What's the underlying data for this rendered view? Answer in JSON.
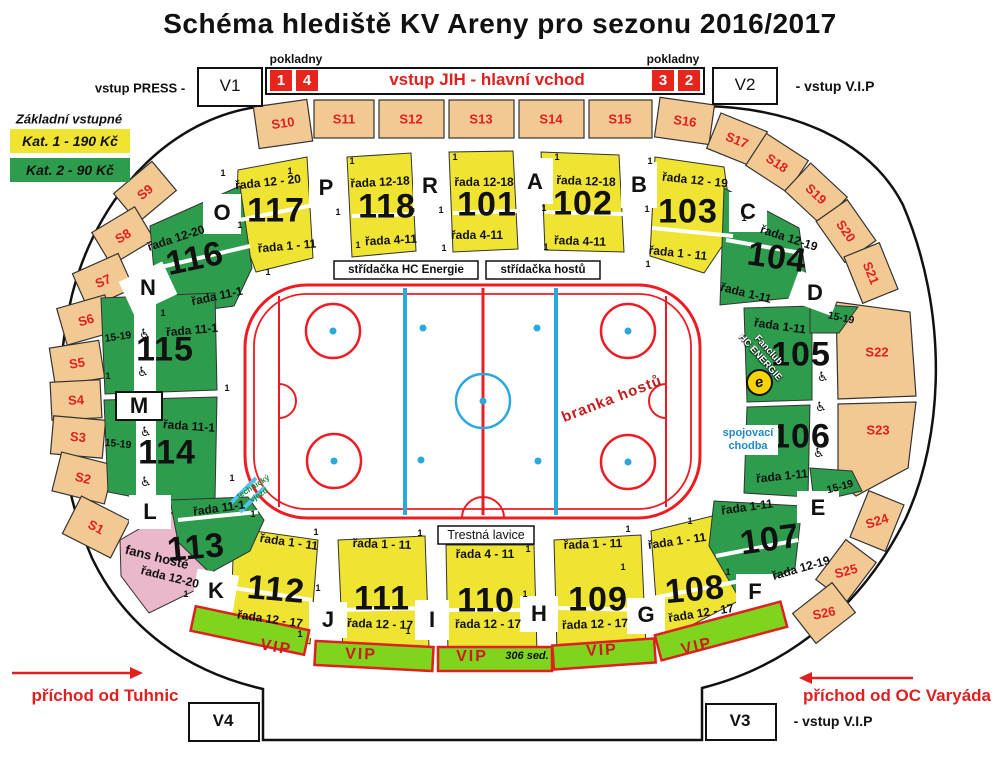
{
  "title": "Schéma hlediště KV Areny pro sezonu 2016/2017",
  "header": {
    "pokladny": "pokladny",
    "vstup_press": "vstup PRESS -",
    "gate": "vstup JIH - hlavní vchod",
    "vstup_vip": "- vstup V.I.P",
    "v1": "V1",
    "v2": "V2",
    "v3": "V3",
    "v4": "V4",
    "ticket_boxes": {
      "b1": "1",
      "b4": "4",
      "b3": "3",
      "b2": "2"
    }
  },
  "legend": {
    "heading": "Základní vstupné",
    "kat1": "Kat. 1 - 190 Kč",
    "kat2": "Kat. 2 - 90 Kč"
  },
  "approach": {
    "left": "příchod od Tuhnic",
    "right": "příchod od OC Varyáda"
  },
  "ring": {
    "s1": "S1",
    "s2": "S2",
    "s3": "S3",
    "s4": "S4",
    "s5": "S5",
    "s6": "S6",
    "s7": "S7",
    "s8": "S8",
    "s9": "S9",
    "s10": "S10",
    "s11": "S11",
    "s12": "S12",
    "s13": "S13",
    "s14": "S14",
    "s15": "S15",
    "s16": "S16",
    "s17": "S17",
    "s18": "S18",
    "s19": "S19",
    "s20": "S20",
    "s21": "S21",
    "s22": "S22",
    "s23": "S23",
    "s24": "S24",
    "s25": "S25",
    "s26": "S26"
  },
  "letters": {
    "a": "A",
    "b": "B",
    "c": "C",
    "d": "D",
    "e": "E",
    "f": "F",
    "g": "G",
    "h": "H",
    "i": "I",
    "j": "J",
    "k": "K",
    "l": "L",
    "m": "M",
    "n": "N",
    "o": "O",
    "p": "P",
    "r": "R"
  },
  "bowl": {
    "s101": {
      "num": "101",
      "top": "řada 12-18",
      "bottom": "řada 4-11"
    },
    "s102": {
      "num": "102",
      "top": "řada 12-18",
      "bottom": "řada 4-11"
    },
    "s103": {
      "num": "103",
      "top": "řada 12 - 19",
      "bottom": "řada 1 - 11"
    },
    "s104": {
      "num": "104",
      "top": "řada 12-19",
      "bottom": "řada 1-11"
    },
    "s105": {
      "num": "105",
      "rows": "řada 1-11"
    },
    "s106": {
      "num": "106",
      "rows": "řada 1-11"
    },
    "s107": {
      "num": "107",
      "top": "řada 1-11",
      "bottom": "řada 12-19"
    },
    "s108": {
      "num": "108",
      "top": "řada 1 - 11",
      "bottom": "řada 12 - 17"
    },
    "s109": {
      "num": "109",
      "top": "řada 1 - 11",
      "bottom": "řada 12 - 17"
    },
    "s110": {
      "num": "110",
      "top": "řada 4 - 11",
      "bottom": "řada 12 - 17"
    },
    "s111": {
      "num": "111",
      "top": "řada 1 - 11",
      "bottom": "řada 12 - 17"
    },
    "s112": {
      "num": "112",
      "top": "řada 1 - 11",
      "bottom": "řada 12 - 17"
    },
    "s113": {
      "num": "113",
      "rows": "řada 11-1"
    },
    "s114": {
      "num": "114",
      "rows": "řada 11-1"
    },
    "s115": {
      "num": "115",
      "rows": "řada 11-1"
    },
    "s116": {
      "num": "116",
      "top": "řada 12-20",
      "bottom": "řada 11-1"
    },
    "s117": {
      "num": "117",
      "top": "řada 12 - 20",
      "bottom": "řada 1 - 11"
    },
    "s118": {
      "num": "118",
      "top": "řada 12-18",
      "bottom": "řada 4-11"
    }
  },
  "rink": {
    "bench_home": "střídačka HC Energie",
    "bench_away": "střídačka hostů",
    "penalty": "Trestná lavice",
    "goal": "branka hostů",
    "tech1": "technický",
    "tech2": "vjezd"
  },
  "fans": {
    "label": "fans hosté",
    "rows": "řada 12-20"
  },
  "fanclub": {
    "line1": "Fanclub",
    "line2": "HC ENERGIE",
    "logo": "e"
  },
  "corridor": {
    "line1": "spojovací",
    "line2": "chodba"
  },
  "vip": {
    "label": "VIP",
    "seats": "306 sed."
  },
  "marks": {
    "one": "1",
    "rows1519": "15-19",
    "wheelchair": "♿"
  },
  "colors": {
    "kat1_yellow": "#F0E433",
    "kat2_green": "#2E9C4D",
    "ring_tan": "#F3C993",
    "fans_pink": "#EBB7CA",
    "vip_green": "#7FD41E",
    "red": "#E01F1F",
    "rink_red": "#ED1C24",
    "rink_blue": "#2BA8E0",
    "corridor_blue": "#2187C9"
  }
}
